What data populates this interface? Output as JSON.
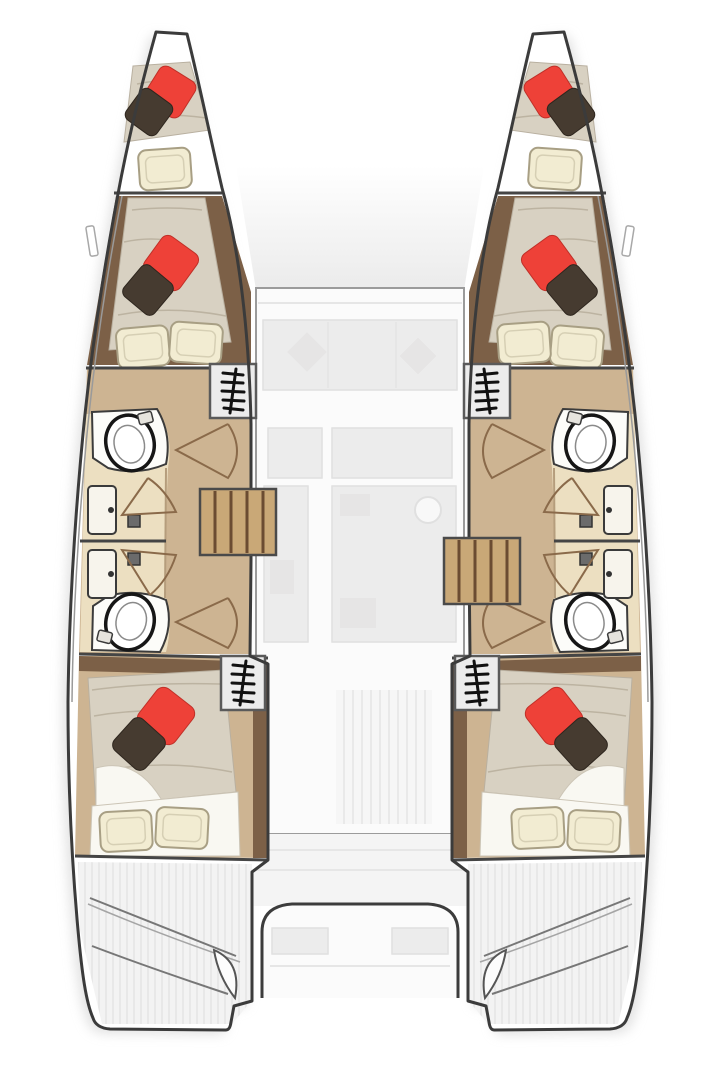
{
  "diagram": {
    "type": "floor-plan",
    "subject": "Catamaran sailboat interior layout, top-down deck plan, bow up",
    "symmetry": "port and starboard hulls mirrored",
    "hulls": [
      {
        "side": "port-left",
        "rooms": [
          {
            "name": "forepeak-berth",
            "furniture": [
              "mattress",
              "red-pillow",
              "dark-pillow",
              "cream-pillow"
            ]
          },
          {
            "name": "forward-cabin",
            "furniture": [
              "double-berth",
              "red-pillow",
              "dark-pillow",
              "cream-pillow",
              "cream-pillow"
            ]
          },
          {
            "name": "forward-head",
            "furniture": [
              "toilet",
              "sink",
              "shower-door",
              "shower-drain"
            ]
          },
          {
            "name": "aft-head",
            "furniture": [
              "toilet",
              "sink",
              "shower-door",
              "shower-drain"
            ]
          },
          {
            "name": "aft-cabin",
            "furniture": [
              "double-berth",
              "red-pillow",
              "dark-pillow",
              "cream-pillow",
              "cream-pillow"
            ]
          },
          {
            "name": "transom-swim-steps"
          }
        ],
        "companionway_ladder_icons": 2
      },
      {
        "side": "starboard-right",
        "rooms": [
          {
            "name": "forepeak-berth",
            "furniture": [
              "mattress",
              "red-pillow",
              "dark-pillow",
              "cream-pillow"
            ]
          },
          {
            "name": "forward-cabin",
            "furniture": [
              "double-berth",
              "red-pillow",
              "dark-pillow",
              "cream-pillow",
              "cream-pillow"
            ]
          },
          {
            "name": "forward-head",
            "furniture": [
              "toilet",
              "sink",
              "shower-door",
              "shower-drain"
            ]
          },
          {
            "name": "aft-head",
            "furniture": [
              "toilet",
              "sink",
              "shower-door",
              "shower-drain"
            ]
          },
          {
            "name": "aft-cabin",
            "furniture": [
              "double-berth",
              "red-pillow",
              "dark-pillow",
              "cream-pillow",
              "cream-pillow"
            ]
          },
          {
            "name": "transom-swim-steps"
          }
        ],
        "companionway_ladder_icons": 2
      }
    ],
    "center_deck": {
      "style": "faded ghosted overlay",
      "areas": [
        "foredeck",
        "saloon-sofa",
        "table",
        "galley-island",
        "side-counter",
        "aft-deck",
        "cockpit-bench"
      ],
      "stair_flights_to_hulls": 2
    },
    "totals": {
      "berths": 6,
      "heads": 4,
      "toilets": 4,
      "sinks": 4,
      "shower_drains": 4,
      "companionway_ladder_icons": 4,
      "central_stair_flights": 2,
      "red_pillows": 6,
      "dark_pillows": 6,
      "cream_pillows": 10,
      "transoms": 2,
      "cockpits": 1
    }
  },
  "colors": {
    "hull_outline": "#3b3b3b",
    "deck_line": "#9a9a9a",
    "wood_floor": "#cdb492",
    "wood_dark": "#7c6047",
    "bathroom_floor": "#ecdfc1",
    "counter_white": "#fcfcf9",
    "mattress": "#d8d1c2",
    "mattress_crease": "#bcb3a1",
    "sheet_white": "#f9f8f2",
    "pillow_red": "#ee4138",
    "pillow_dark": "#463b30",
    "pillow_cream": "#f2ecd2",
    "pillow_cream_stroke": "#a89f84",
    "stairs_wood": "#c9a877",
    "stairs_divider": "#6b4c32",
    "ladder_box_fill": "#ececec",
    "ladder_box_stroke": "#5a5a5a",
    "ladder_glyph": "#111111",
    "door_stroke": "#8a6a4a",
    "saloon_fill": "#fbfbfb",
    "saloon_stroke": "#9b9b9b",
    "faint_fill": "#ececec",
    "faint_stroke": "#e0e0e0",
    "deck_faded": "#f4f4f4",
    "cockpit_stroke": "#3c3c3c",
    "toilet_stroke": "#161616",
    "fixture_stroke": "#3a3a3a",
    "shadow": "#d8d8d8"
  }
}
